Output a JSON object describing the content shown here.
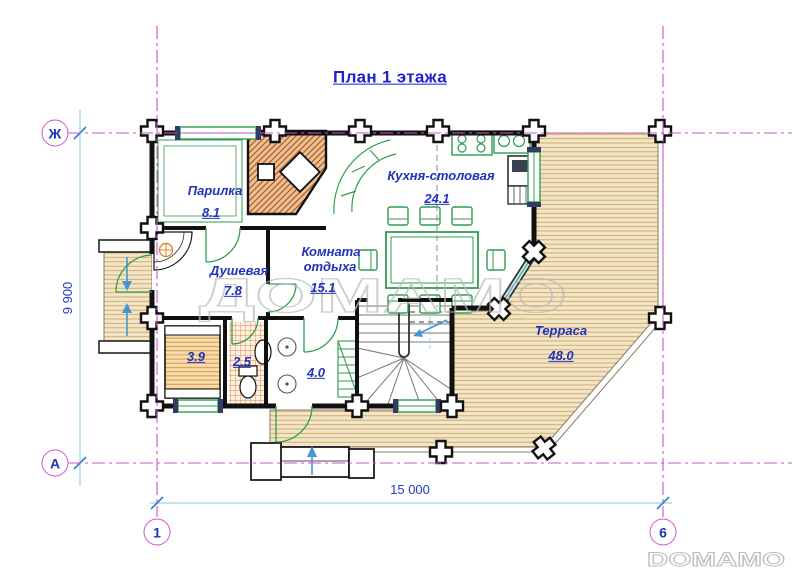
{
  "title": "План 1 этажа",
  "rooms": {
    "parilka": {
      "name": "Парилка",
      "area": "8.1"
    },
    "dushevaya": {
      "name": "Душевая",
      "area": "7.8"
    },
    "komnata_otdyha": {
      "name_line1": "Комната",
      "name_line2": "отдыха",
      "area": "15.1"
    },
    "kuhnya_stolovaya": {
      "name": "Кухня-столовая",
      "area": "24.1"
    },
    "terrasa": {
      "name": "Терраса",
      "area": "48.0"
    },
    "sauna_room": {
      "area": "3.9"
    },
    "wc": {
      "area": "2.5"
    },
    "hall": {
      "area": "4.0"
    }
  },
  "axes": {
    "row_top": "Ж",
    "row_bottom": "А",
    "col_left": "1",
    "col_right": "6"
  },
  "dimensions": {
    "horizontal": "15 000",
    "vertical": "9 900"
  },
  "watermarks": {
    "center": "ДОМАМО",
    "corner": "DOMAMO"
  },
  "colors": {
    "label_blue": "#2233bb",
    "axis_magenta": "#cf52cf",
    "dimension_cyan": "#8fd2e2",
    "wall_black": "#111111",
    "furniture_green": "#2f9e4f",
    "deck_tan": "#f3e6c8"
  }
}
